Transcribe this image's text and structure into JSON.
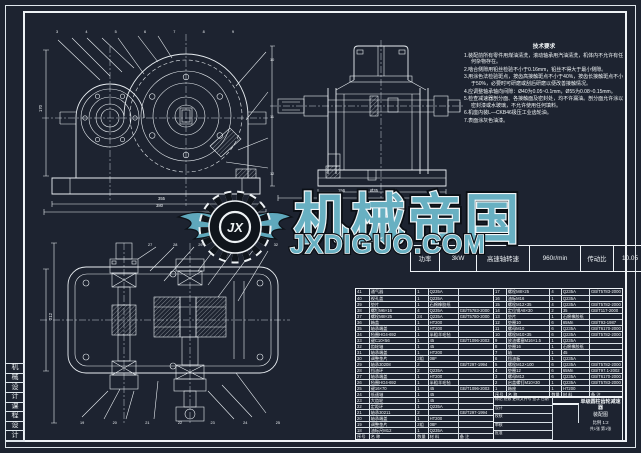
{
  "frame": {
    "side_label_chars": [
      "机",
      "械",
      "设",
      "计",
      "课",
      "程",
      "设",
      "计"
    ]
  },
  "notes": {
    "title": "技术要求",
    "lines": [
      "1.装配前所有零件用煤油清洗，滚动轴承用汽油清洗，机体内不允许有任何杂物存在。",
      "2.啮合侧隙用铅丝检验不小于0.16mm，铅丝不得大于最小侧隙。",
      "3.用涂色法检验斑点，按齿高接触斑点不小于40%，按齿长接触斑点不小于50%，必要时可研磨或刮后研磨以便改善接触情况。",
      "4.应调整轴承轴向间隙：Ø40为0.05~0.1mm，Ø55为0.08~0.15mm。",
      "5.检查减速器剖分面、各接触面及密封处，均不许漏油。剖分面允许涂以密封漆或水玻璃，不允许使用任何填料。",
      "6.机座内装L—CKB46极压工业齿轮油。",
      "7.表面涂灰色油漆。"
    ]
  },
  "params": {
    "label": "技术参数表",
    "cells": [
      "功率",
      "3kW",
      "高速轴转速",
      "960r/min",
      "传动比",
      "10.05"
    ]
  },
  "watermark": {
    "monogram": "JX",
    "brand": "机械帝国",
    "site": "JXDIGUO.COM"
  },
  "parts": {
    "left": {
      "widths": [
        "10%",
        "34%",
        "9%",
        "22%",
        "25%"
      ],
      "rows": [
        [
          "41",
          "通气器",
          "1",
          "Q235A",
          ""
        ],
        [
          "40",
          "视孔盖",
          "1",
          "Q235A",
          ""
        ],
        [
          "39",
          "垫片",
          "1",
          "石棉橡胶纸",
          ""
        ],
        [
          "38",
          "螺钉M6×16",
          "4",
          "Q235A",
          "GB/T5783-2000"
        ],
        [
          "37",
          "螺栓M8×25",
          "24",
          "Q235A",
          "GB/T5780-2000"
        ],
        [
          "36",
          "箱盖",
          "1",
          "HT200",
          ""
        ],
        [
          "35",
          "轴承端盖",
          "1",
          "HT200",
          ""
        ],
        [
          "34",
          "毡圈HG4-692",
          "1",
          "半粗羊毛毡",
          ""
        ],
        [
          "33",
          "键C10×56",
          "1",
          "45",
          "GB/T1096-2003"
        ],
        [
          "32",
          "齿轮轴",
          "1",
          "45",
          ""
        ],
        [
          "31",
          "轴承端盖",
          "1",
          "HT200",
          ""
        ],
        [
          "30",
          "调整垫片",
          "2组",
          "08F",
          ""
        ],
        [
          "29",
          "轴承30208",
          "2",
          "",
          "GB/T297-1994"
        ],
        [
          "28",
          "挡油环",
          "2",
          "Q235A",
          ""
        ],
        [
          "27",
          "轴承端盖",
          "1",
          "HT200",
          ""
        ],
        [
          "26",
          "毡圈HG4-692",
          "1",
          "半粗羊毛毡",
          ""
        ],
        [
          "25",
          "键16×70",
          "1",
          "45",
          "GB/T1096-2003"
        ],
        [
          "24",
          "低速轴",
          "1",
          "45",
          ""
        ],
        [
          "23",
          "大齿轮",
          "1",
          "45",
          ""
        ],
        [
          "22",
          "定距环",
          "1",
          "Q235A",
          ""
        ],
        [
          "21",
          "轴承30211",
          "2",
          "",
          "GB/T297-1994"
        ],
        [
          "20",
          "轴承端盖",
          "1",
          "HT200",
          ""
        ],
        [
          "19",
          "调整垫片",
          "2组",
          "08F",
          ""
        ],
        [
          "18",
          "油标尺M12",
          "1",
          "Q235A",
          ""
        ],
        [
          "序号",
          "名 称",
          "数量",
          "材 料",
          "备 注"
        ]
      ]
    },
    "right": {
      "widths": [
        "10%",
        "34%",
        "9%",
        "22%",
        "25%"
      ],
      "rows": [
        [
          "17",
          "螺栓M8×25",
          "4",
          "Q235A",
          "GB/T5783-2000"
        ],
        [
          "16",
          "油标M16",
          "1",
          "Q235A",
          ""
        ],
        [
          "15",
          "螺栓M12×35",
          "4",
          "Q235A",
          "GB/T5782-2000"
        ],
        [
          "14",
          "定位销A8×30",
          "2",
          "35",
          "GB/T117-2000"
        ],
        [
          "13",
          "垫片",
          "1",
          "石棉橡胶纸",
          ""
        ],
        [
          "12",
          "垫圈10",
          "6",
          "65Mn",
          "GB/T93-1987"
        ],
        [
          "11",
          "螺母M10",
          "6",
          "Q235A",
          "GB/T6170-2000"
        ],
        [
          "10",
          "螺栓M10×35",
          "6",
          "Q235A",
          "GB/T5782-2000"
        ],
        [
          "9",
          "放油螺塞M16×1.5",
          "1",
          "Q235A",
          ""
        ],
        [
          "8",
          "垫圈16",
          "1",
          "石棉橡胶纸",
          ""
        ],
        [
          "7",
          "轴",
          "1",
          "45",
          ""
        ],
        [
          "6",
          "挡油板",
          "1",
          "Q235A",
          ""
        ],
        [
          "5",
          "螺栓M12×100",
          "6",
          "Q235A",
          "GB/T5782-2000"
        ],
        [
          "4",
          "垫圈12",
          "6",
          "65Mn",
          "GB/T97.1-2002"
        ],
        [
          "3",
          "螺母M12",
          "6",
          "Q235A",
          "GB/T6170-2000"
        ],
        [
          "2",
          "启盖螺钉M10×30",
          "1",
          "Q235A",
          "GB/T5783-2000"
        ],
        [
          "1",
          "箱座",
          "1",
          "HT200",
          ""
        ],
        [
          "序号",
          "名 称",
          "数量",
          "材 料",
          "备 注"
        ]
      ]
    }
  },
  "title_block": {
    "left_rows": [
      "标记 处数 更改文件号 签字 日期",
      "设计",
      "校核",
      "审核",
      "批准"
    ],
    "product": "单级圆柱齿轮减速器",
    "sheet": "装配图",
    "scale": "比例 1:2",
    "sheets": "共1张 第1张"
  },
  "dims": {
    "front_w": "355",
    "front_w2": "380",
    "front_h": "170",
    "side_w": "156",
    "side_d": "Ø35",
    "side_w2": "175",
    "top_h": "212"
  },
  "callouts": {
    "front_top": [
      "3",
      "4",
      "5",
      "6",
      "7",
      "8",
      "9"
    ],
    "front_right": [
      "10",
      "11",
      "12"
    ],
    "top_top": [
      "27",
      "28",
      "29",
      "30",
      "31",
      "32"
    ],
    "top_bottom": [
      "19",
      "20",
      "21",
      "22",
      "23",
      "24",
      "25"
    ]
  }
}
